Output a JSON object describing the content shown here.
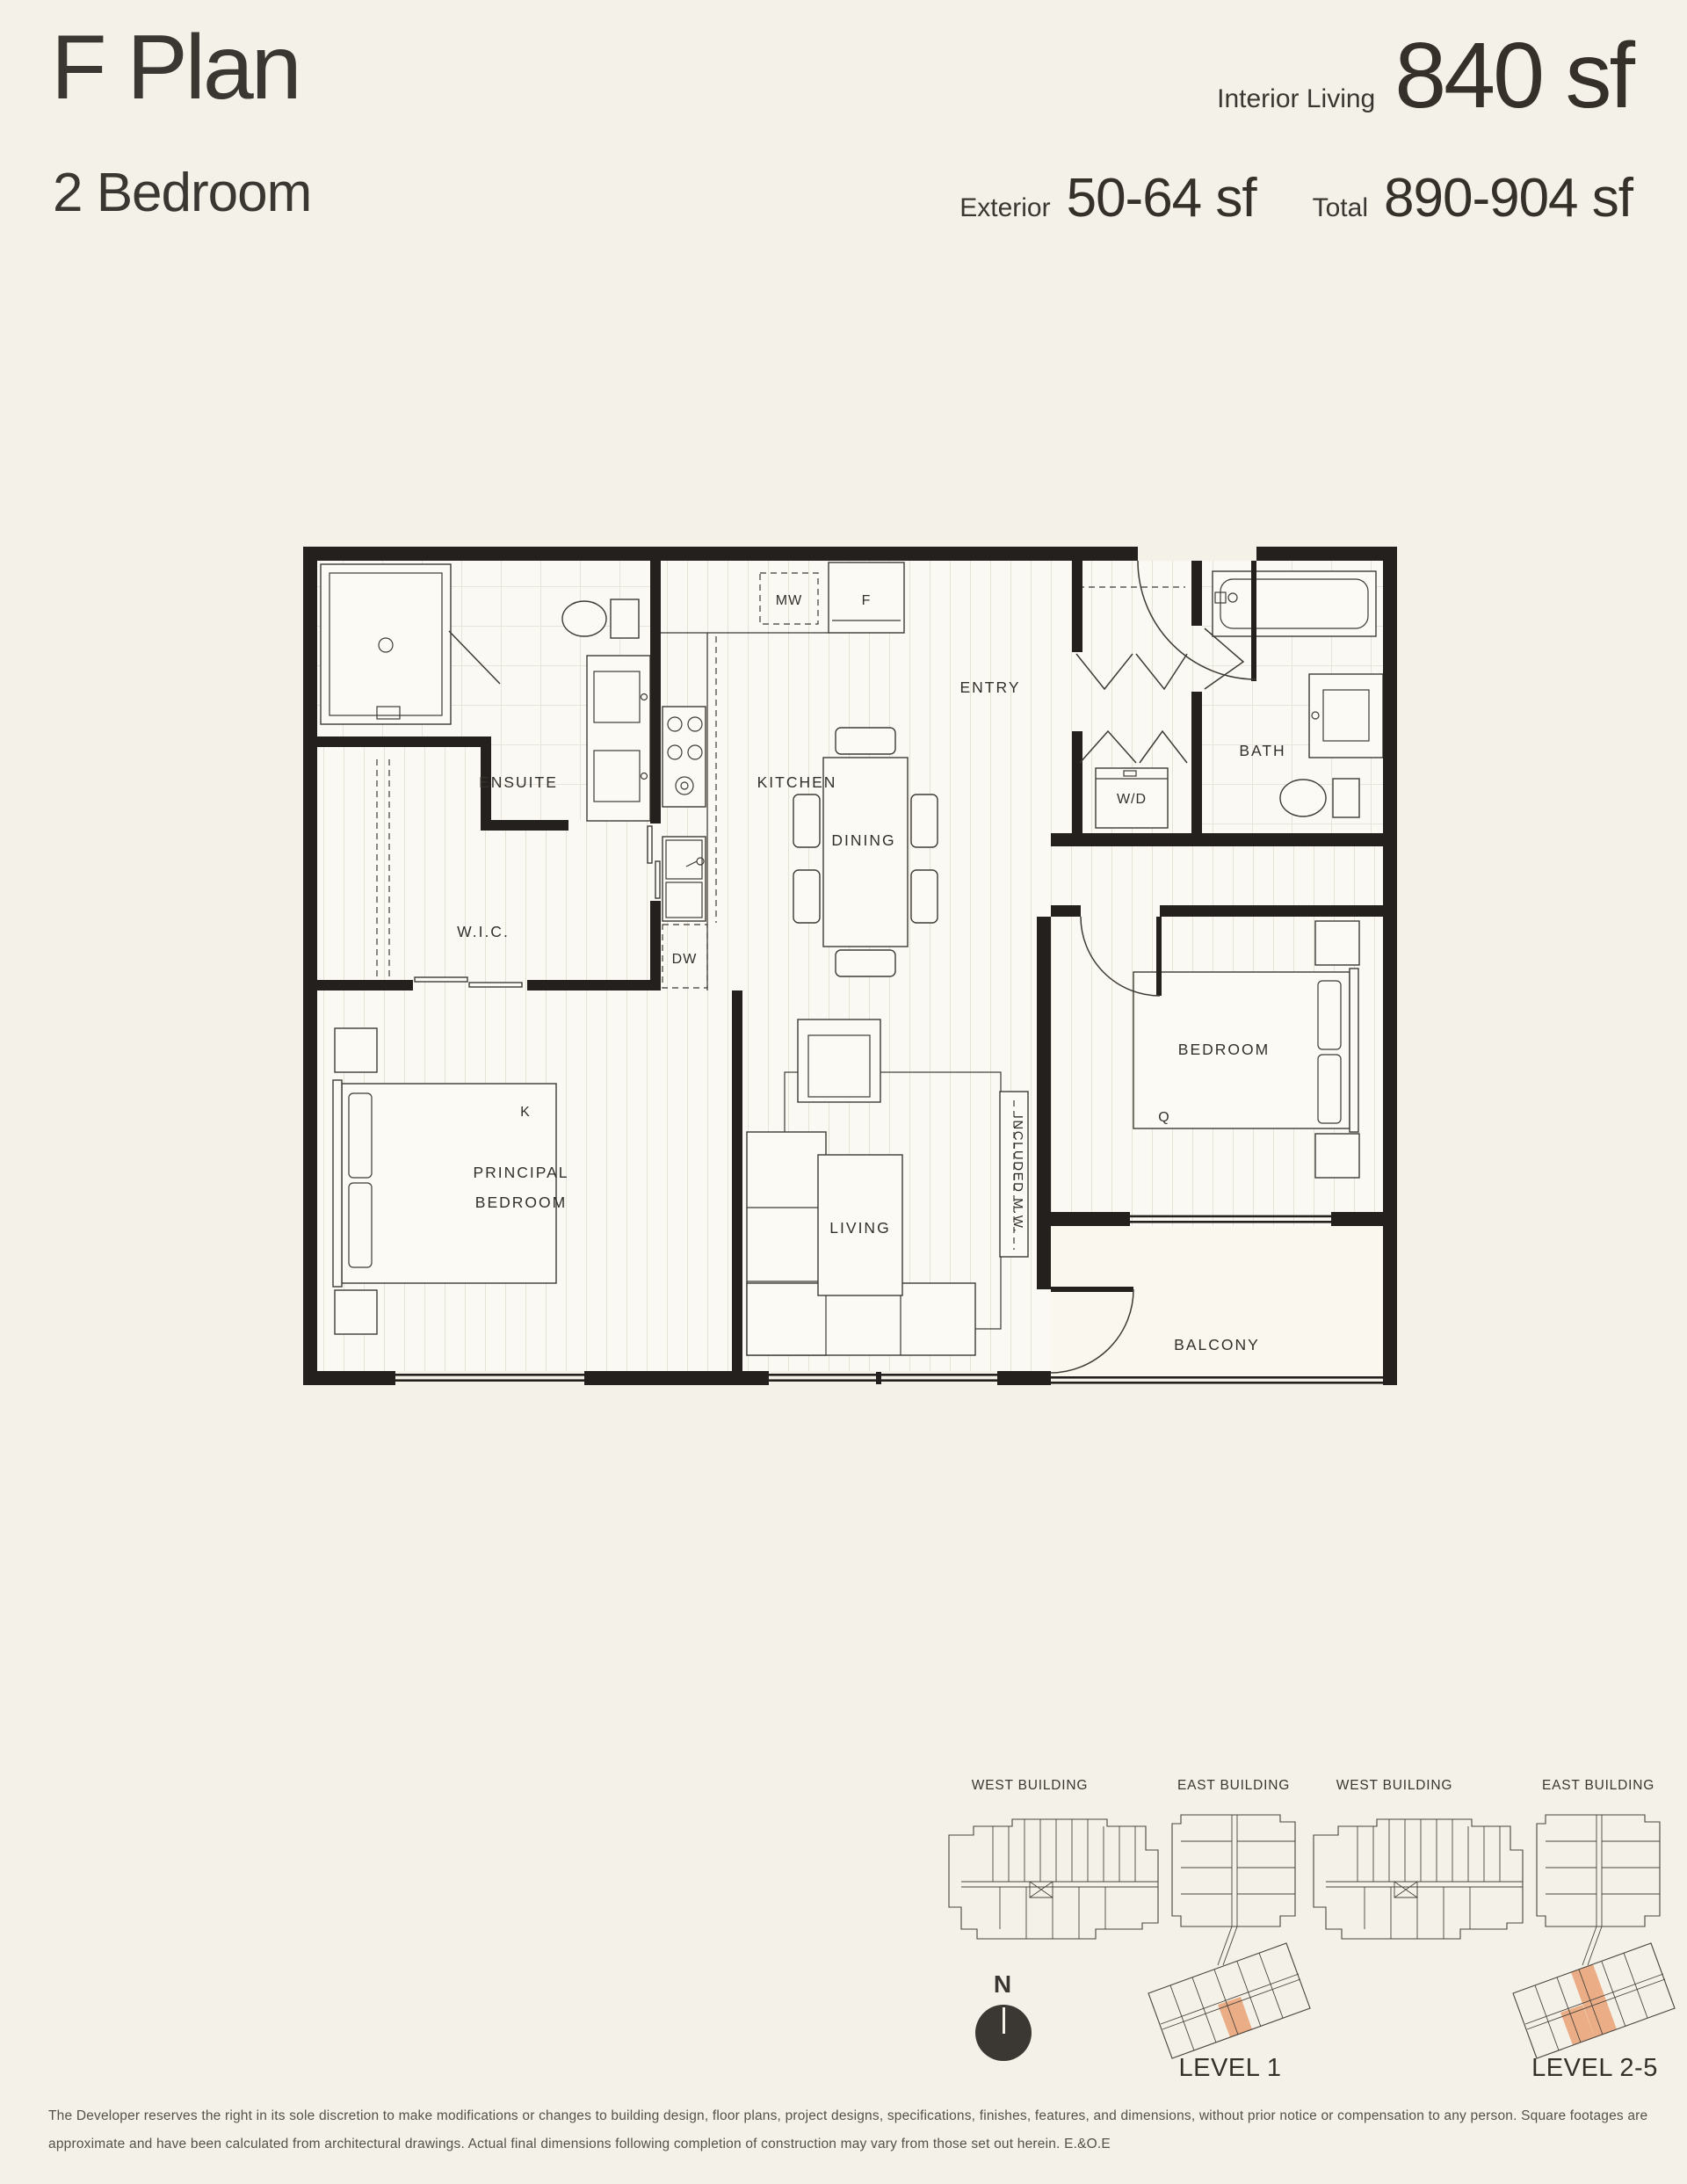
{
  "colors": {
    "background": "#F4F1E8",
    "wall_ink": "#23201D",
    "text_ink": "#3A3631",
    "highlight_unit": "#EBAD85"
  },
  "header": {
    "title": "F Plan",
    "subtitle": "2 Bedroom"
  },
  "stats": {
    "interior_label": "Interior Living",
    "interior_value": "840 sf",
    "exterior_label": "Exterior",
    "exterior_value": "50-64 sf",
    "total_label": "Total",
    "total_value": "890-904 sf"
  },
  "plan": {
    "rooms": {
      "ensuite": "ENSUITE",
      "wic": "W.I.C.",
      "kitchen": "KITCHEN",
      "mw": "MW",
      "fridge": "F",
      "dw": "DW",
      "entry": "ENTRY",
      "bath": "BATH",
      "wd": "W/D",
      "dining": "DINING",
      "principal_line1": "PRINCIPAL",
      "principal_line2": "BEDROOM",
      "bed_k": "K",
      "living": "LIVING",
      "included_mw": "INCLUDED M.W.",
      "bedroom": "BEDROOM",
      "bed_q": "Q",
      "balcony": "BALCONY"
    }
  },
  "keyplans": [
    {
      "west_label": "WEST BUILDING",
      "east_label": "EAST BUILDING",
      "level_label": "LEVEL 1"
    },
    {
      "west_label": "WEST BUILDING",
      "east_label": "EAST BUILDING",
      "level_label": "LEVEL 2-5"
    }
  ],
  "compass": {
    "north_label": "N"
  },
  "footer": {
    "disclaimer": "The Developer reserves the right in its sole discretion to make modifications or changes to building design, floor plans, project designs, specifications, finishes, features, and dimensions, without prior notice or compensation to any person. Square footages are approximate and have been calculated from architectural drawings. Actual final dimensions following completion of construction may vary from those set out herein. E.&O.E"
  }
}
